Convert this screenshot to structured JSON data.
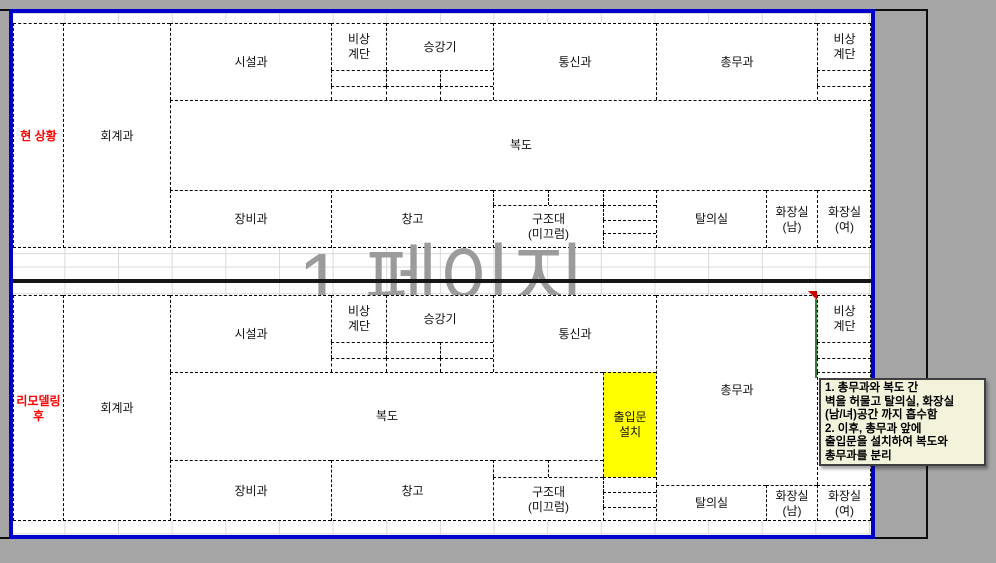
{
  "app": {
    "watermark": "1 페이지",
    "view_mode_colors": {
      "page_border_blue": "#0000CD",
      "background_gray": "#A5A5A5",
      "watermark_gray": "#9B9B9B",
      "highlight_yellow": "#FFFF00",
      "label_red": "#FF0000",
      "comment_background": "#F3F3DC"
    }
  },
  "plans": {
    "current": {
      "label": "현 상황"
    },
    "after": {
      "label": "리모델링\n후"
    }
  },
  "rooms": {
    "accounting": "회계과",
    "facilities": "시설과",
    "emergency_stairs": "비상\n계단",
    "elevator": "승강기",
    "communications": "통신과",
    "general_affairs": "총무과",
    "corridor": "복도",
    "equipment": "장비과",
    "warehouse": "창고",
    "rescue_slide": "구조대\n(미끄럼)",
    "dressing_room": "탈의실",
    "restroom_men": "화장실\n(남)",
    "restroom_women": "화장실\n(여)",
    "door_install": "출입문\n설치"
  },
  "comment": {
    "text": "1. 총무과와 복도 간\n벽을 허물고 탈의실, 화장실\n(남/녀)공간 까지 흡수함\n2. 이후, 총무과 앞에\n출입문을 설치하여 복도와\n총무과를 분리"
  }
}
